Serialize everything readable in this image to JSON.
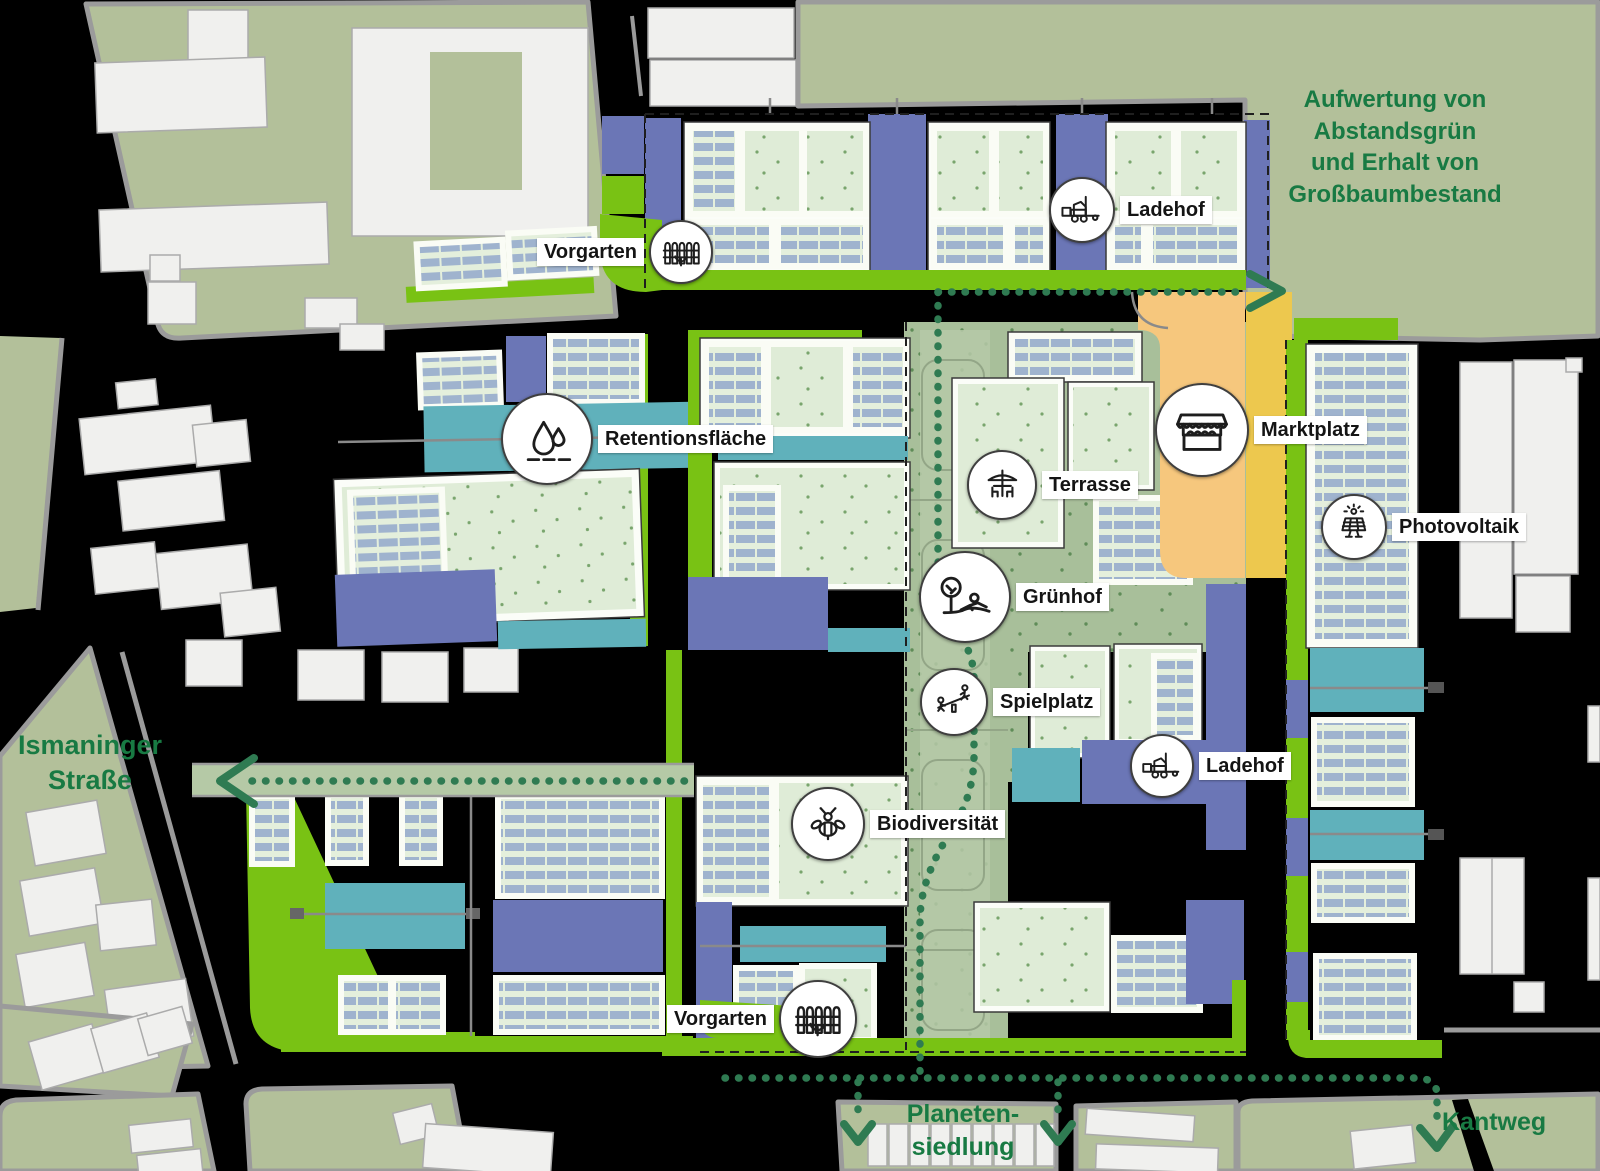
{
  "colors": {
    "background": "#000000",
    "context_block_green": "#b3c09a",
    "building_white": "#f0f0ee",
    "road_gray": "#9b9b9b",
    "lime_green_strip": "#79c214",
    "slate_blue_zone": "#6b76b6",
    "teal_retention": "#60b1bb",
    "courtyard_green": "#a8bf9a",
    "pale_building_green": "#e4efdc",
    "solar_panel_blue": "#9fb3ce",
    "marktplatz_orange": "#f6c77d",
    "marktplatz_yellow": "#edc84e",
    "path_dot_green": "#2f7b52",
    "annotation_text_green": "#187a43",
    "label_text": "#141414",
    "label_background": "#ffffff"
  },
  "callouts": [
    {
      "id": "vorgarten-top",
      "label": "Vorgarten",
      "icon": "fence"
    },
    {
      "id": "ladehof-top",
      "label": "Ladehof",
      "icon": "forklift"
    },
    {
      "id": "retentionsflaeche",
      "label": "Retentionsfläche",
      "icon": "water-drops"
    },
    {
      "id": "marktplatz",
      "label": "Marktplatz",
      "icon": "market-stall"
    },
    {
      "id": "terrasse",
      "label": "Terrasse",
      "icon": "parasol-table"
    },
    {
      "id": "gruenhof",
      "label": "Grünhof",
      "icon": "tree-person"
    },
    {
      "id": "spielplatz",
      "label": "Spielplatz",
      "icon": "seesaw"
    },
    {
      "id": "ladehof-sued",
      "label": "Ladehof",
      "icon": "forklift"
    },
    {
      "id": "biodiversitaet",
      "label": "Biodiversität",
      "icon": "bee"
    },
    {
      "id": "vorgarten-sued",
      "label": "Vorgarten",
      "icon": "fence"
    },
    {
      "id": "photovoltaik",
      "label": "Photovoltaik",
      "icon": "solar-panel"
    }
  ],
  "annotations": {
    "aufwertung": {
      "lines": [
        "Aufwertung von",
        "Abstandsgrün",
        "und Erhalt von",
        "Großbaumbestand"
      ]
    },
    "ismaninger": {
      "lines": [
        "Ismaninger",
        "Straße"
      ]
    },
    "planetensiedlung": {
      "lines": [
        "Planeten-",
        "siedlung"
      ]
    },
    "kantweg": {
      "lines": [
        "Kantweg"
      ]
    }
  }
}
